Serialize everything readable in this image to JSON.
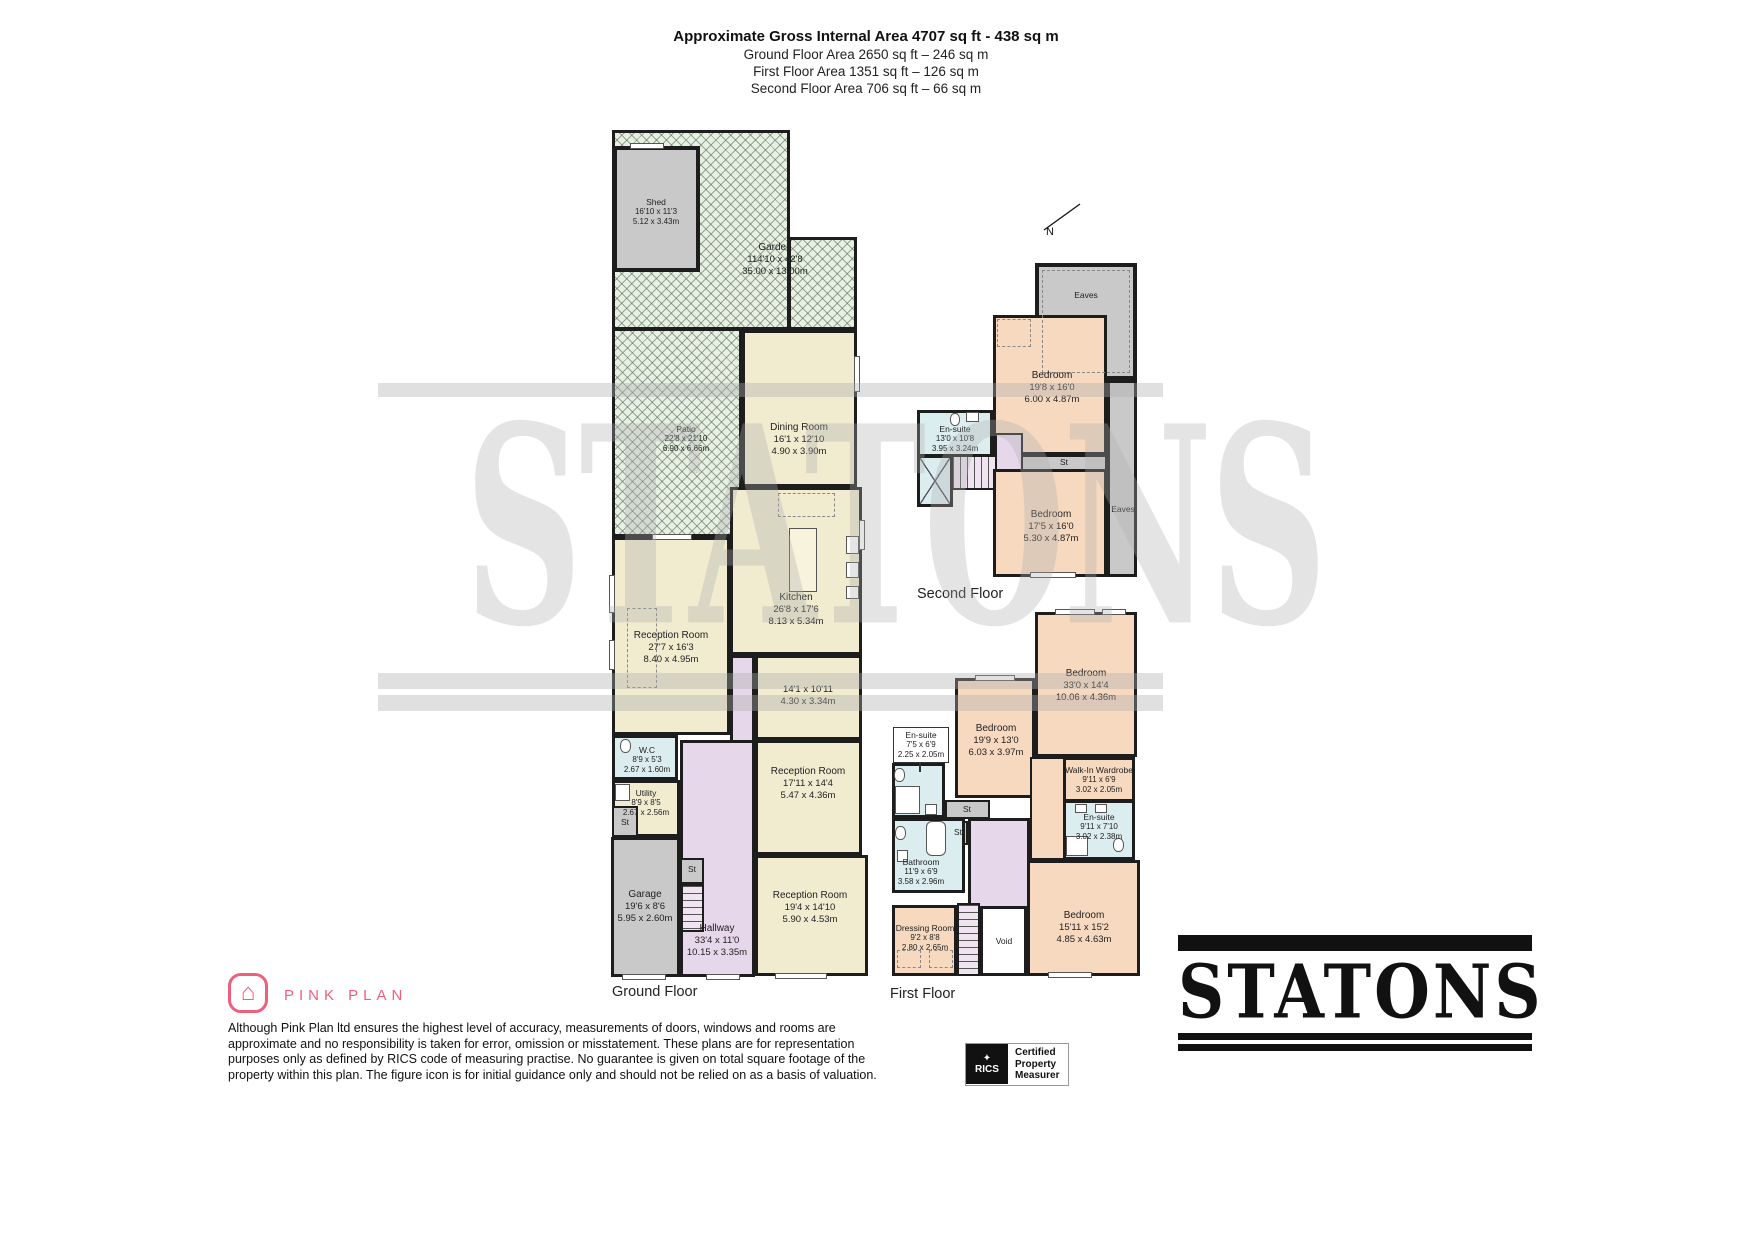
{
  "header": {
    "title": "Approximate Gross Internal Area 4707 sq ft - 438 sq m",
    "subtitle_lines": [
      "Ground Floor Area 2650 sq ft – 246 sq m",
      "First Floor Area 1351 sq ft – 126 sq m",
      "Second Floor Area 706 sq ft – 66 sq m"
    ]
  },
  "floors": {
    "ground": "Ground Floor",
    "first": "First Floor",
    "second": "Second Floor"
  },
  "compass": {
    "north": "N"
  },
  "annotations": {
    "st": "St",
    "eaves": "Eaves",
    "void": "Void"
  },
  "rooms": {
    "shed": {
      "name": "Shed",
      "ft": "16'10 x 11'3",
      "m": "5.12 x 3.43m"
    },
    "garden": {
      "name": "Garden",
      "ft": "114'10 x 42'8",
      "m": "35.00 x 13.00m"
    },
    "patio": {
      "name": "Patio",
      "ft": "22'8 x 21'10",
      "m": "6.90 x 6.66m"
    },
    "dining": {
      "name": "Dining Room",
      "ft": "16'1 x 12'10",
      "m": "4.90 x 3.90m"
    },
    "kitchen": {
      "name": "Kitchen",
      "ft": "26'8 x 17'6",
      "m": "8.13 x 5.34m"
    },
    "reception1": {
      "name": "Reception Room",
      "ft": "27'7 x 16'3",
      "m": "8.40 x 4.95m"
    },
    "room141": {
      "ft": "14'1 x 10'11",
      "m": "4.30 x 3.34m"
    },
    "wc": {
      "name": "W.C",
      "ft": "8'9 x 5'3",
      "m": "2.67 x 1.60m"
    },
    "utility": {
      "name": "Utility",
      "ft": "8'9 x 8'5",
      "m": "2.67 x 2.56m"
    },
    "reception2": {
      "name": "Reception Room",
      "ft": "17'11 x 14'4",
      "m": "5.47 x 4.36m"
    },
    "garage": {
      "name": "Garage",
      "ft": "19'6 x 8'6",
      "m": "5.95 x 2.60m"
    },
    "hallway": {
      "name": "Hallway",
      "ft": "33'4 x 11'0",
      "m": "10.15 x 3.35m"
    },
    "reception3": {
      "name": "Reception Room",
      "ft": "19'4 x 14'10",
      "m": "5.90 x 4.53m"
    },
    "sf_bedroom1": {
      "name": "Bedroom",
      "ft": "19'8 x 16'0",
      "m": "6.00 x 4.87m"
    },
    "sf_bedroom2": {
      "name": "Bedroom",
      "ft": "17'5 x 16'0",
      "m": "5.30 x 4.87m"
    },
    "sf_ensuite": {
      "name": "En-suite",
      "ft": "13'0 x 10'8",
      "m": "3.95 x 3.24m"
    },
    "ff_bedroom1": {
      "name": "Bedroom",
      "ft": "33'0 x 14'4",
      "m": "10.06 x 4.36m"
    },
    "ff_bedroom2": {
      "name": "Bedroom",
      "ft": "19'9 x 13'0",
      "m": "6.03 x 3.97m"
    },
    "ff_ensuite1": {
      "name": "En-suite",
      "ft": "7'5 x 6'9",
      "m": "2.25 x 2.05m"
    },
    "walkin": {
      "name": "Walk-In Wardrobe",
      "ft": "9'11 x 6'9",
      "m": "3.02 x 2.05m"
    },
    "ff_ensuite2": {
      "name": "En-suite",
      "ft": "9'11 x 7'10",
      "m": "3.02 x 2.38m"
    },
    "bathroom": {
      "name": "Bathroom",
      "ft": "11'9 x 6'9",
      "m": "3.58 x 2.96m"
    },
    "dressing": {
      "name": "Dressing Room",
      "ft": "9'2 x 8'8",
      "m": "2.80 x 2.65m"
    },
    "ff_bedroom3": {
      "name": "Bedroom",
      "ft": "15'11 x 15'2",
      "m": "4.85 x 4.63m"
    }
  },
  "watermark": "STATONS",
  "footer": {
    "brand": "PINK PLAN",
    "disclaimer_lines": [
      "Although Pink Plan ltd ensures the highest level of accuracy, measurements of doors, windows and rooms are",
      "approximate and no responsibility is taken for error, omission or misstatement. These plans are for representation",
      "purposes only as defined by RICS code of measuring practise. No guarantee is given on total square footage of the",
      "property within this plan. The figure icon is for initial guidance only and should not be relied on as a basis of valuation."
    ],
    "rics_label": "RICS",
    "rics_cert_lines": [
      "Certified",
      "Property",
      "Measurer"
    ],
    "logo": "STATONS"
  },
  "colors": {
    "brand_pink": "#ee5f7d",
    "cream": "#f1ebcf",
    "peach": "#f7d9bf",
    "wet_blue": "#dcedef",
    "hall_lavender": "#e7d7ea",
    "gray": "#c9c9c9",
    "garden_green": "#e7f0e3",
    "wall": "#1d1d1d"
  }
}
